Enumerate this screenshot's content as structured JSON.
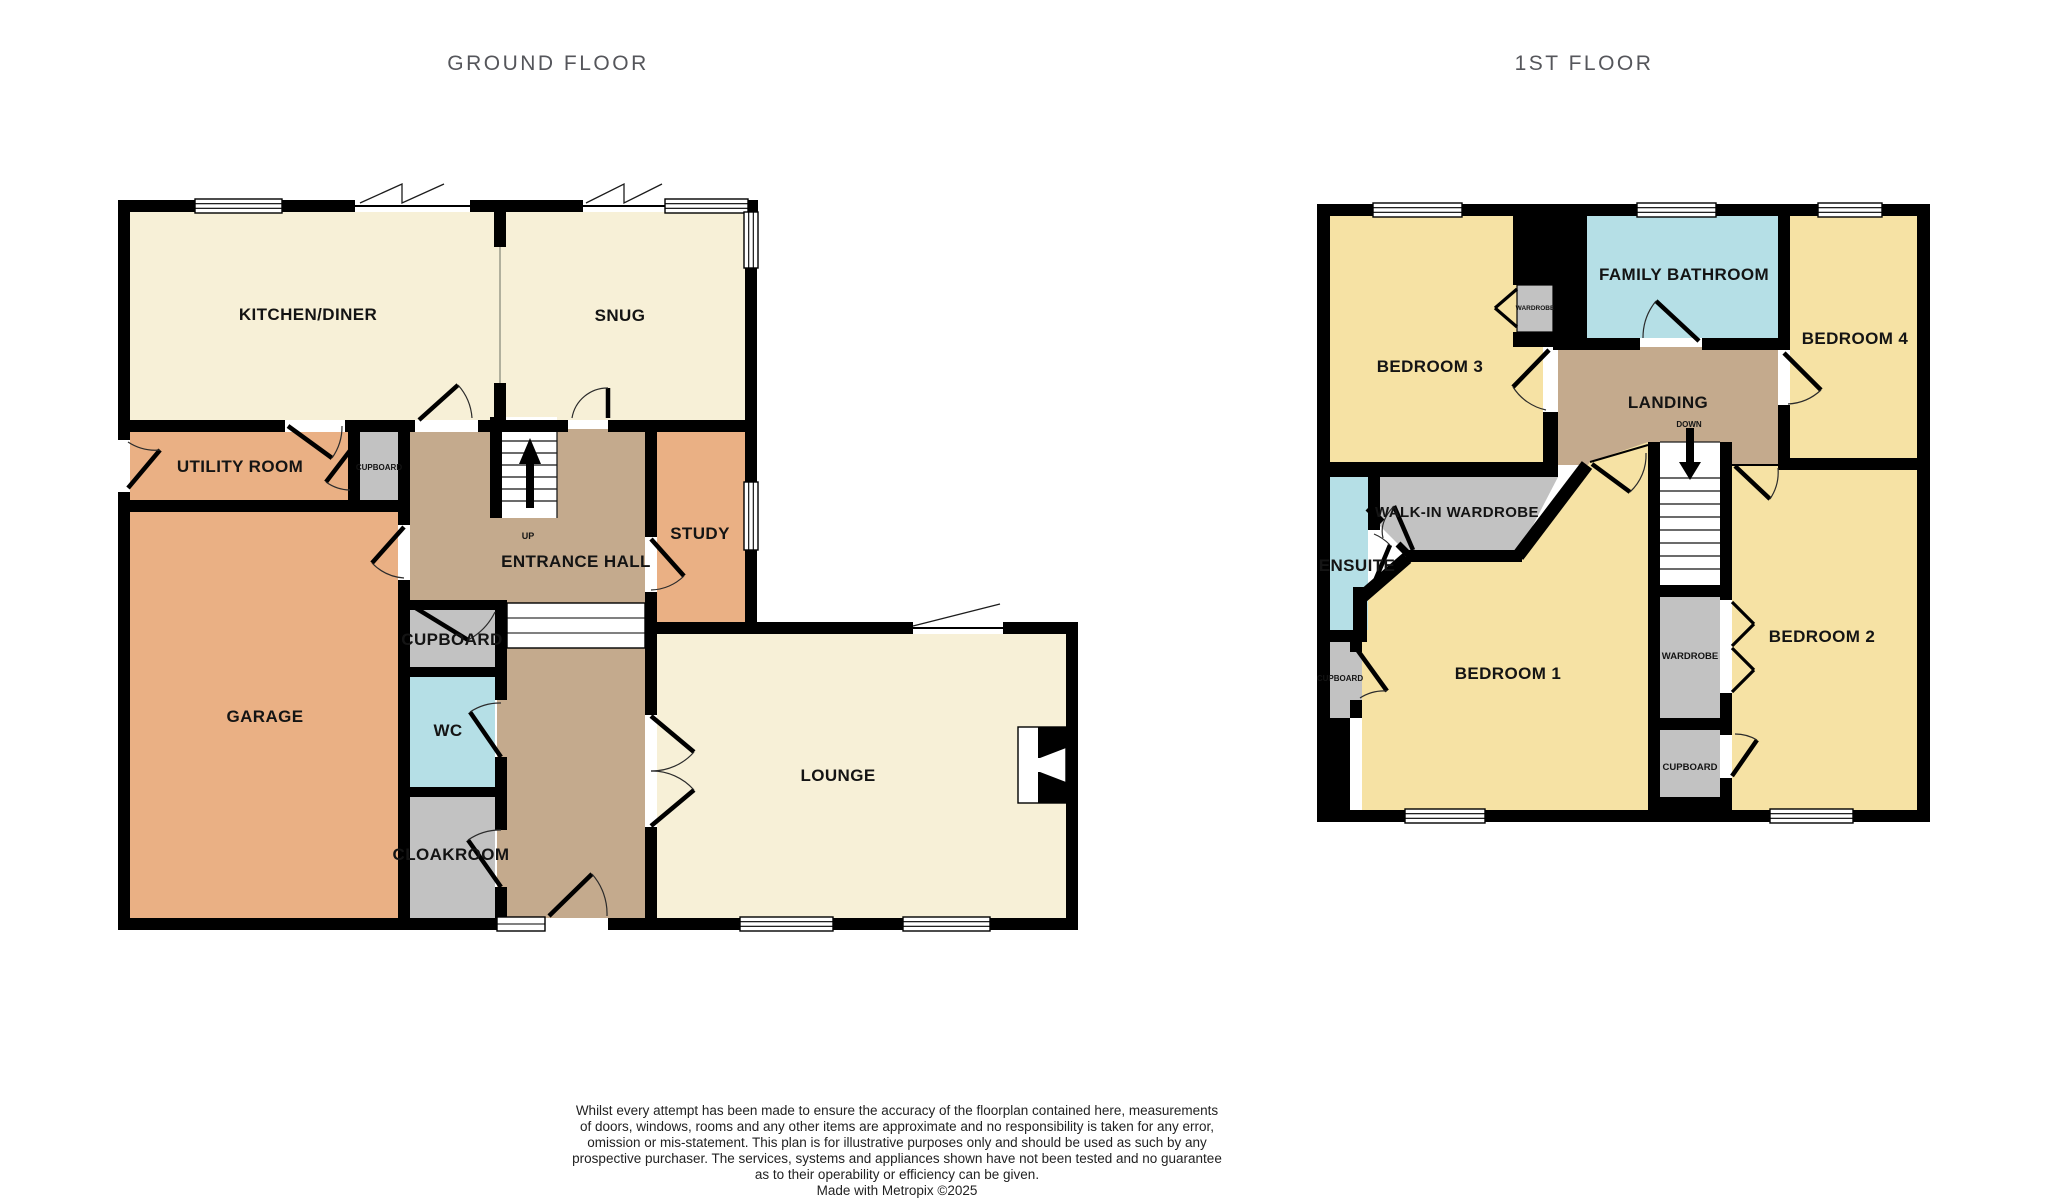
{
  "meta": {
    "type": "floorplan",
    "maker": "Metropix"
  },
  "colors": {
    "cream_room": "#F7F0D7",
    "orange_room": "#EAB084",
    "hall_tan": "#C4AA8D",
    "cupboard_gray": "#C2C2C2",
    "wet_room_blue": "#B5DFE6",
    "bedroom_yellow": "#F6E2A4",
    "wall_black": "#000000",
    "title_gray": "#55565B"
  },
  "floors": {
    "ground": {
      "title": "GROUND FLOOR",
      "rooms": {
        "kitchen_diner": "KITCHEN/DINER",
        "snug": "SNUG",
        "utility_room": "UTILITY ROOM",
        "cupboard_small": "CUPBOARD",
        "study": "STUDY",
        "entrance_hall": "ENTRANCE HALL",
        "stairs_up": "UP",
        "cupboard": "CUPBOARD",
        "garage": "GARAGE",
        "wc": "WC",
        "cloakroom": "CLOAKROOM",
        "lounge": "LOUNGE"
      }
    },
    "first": {
      "title": "1ST FLOOR",
      "rooms": {
        "bedroom3": "BEDROOM 3",
        "wardrobe_small": "WARDROBE",
        "family_bathroom": "FAMILY BATHROOM",
        "bedroom4": "BEDROOM 4",
        "landing": "LANDING",
        "stairs_down": "DOWN",
        "walk_in_wardrobe": "WALK-IN WARDROBE",
        "ensuite": "ENSUITE",
        "bedroom1": "BEDROOM 1",
        "wardrobe": "WARDROBE",
        "cupboard_mid": "CUPBOARD",
        "cupboard_left": "CUPBOARD",
        "bedroom2": "BEDROOM 2"
      }
    }
  },
  "footer": {
    "disclaimer_lines": [
      "Whilst every attempt has been made to ensure the accuracy of the floorplan contained here, measurements",
      "of doors, windows, rooms and any other items are approximate and no responsibility is taken for any error,",
      "omission or mis-statement. This plan is for illustrative purposes only and should be used as such by any",
      "prospective purchaser. The services, systems and appliances shown have not been tested and no guarantee",
      "as to their operability or efficiency can be given.",
      "Made with Metropix ©2025"
    ]
  }
}
